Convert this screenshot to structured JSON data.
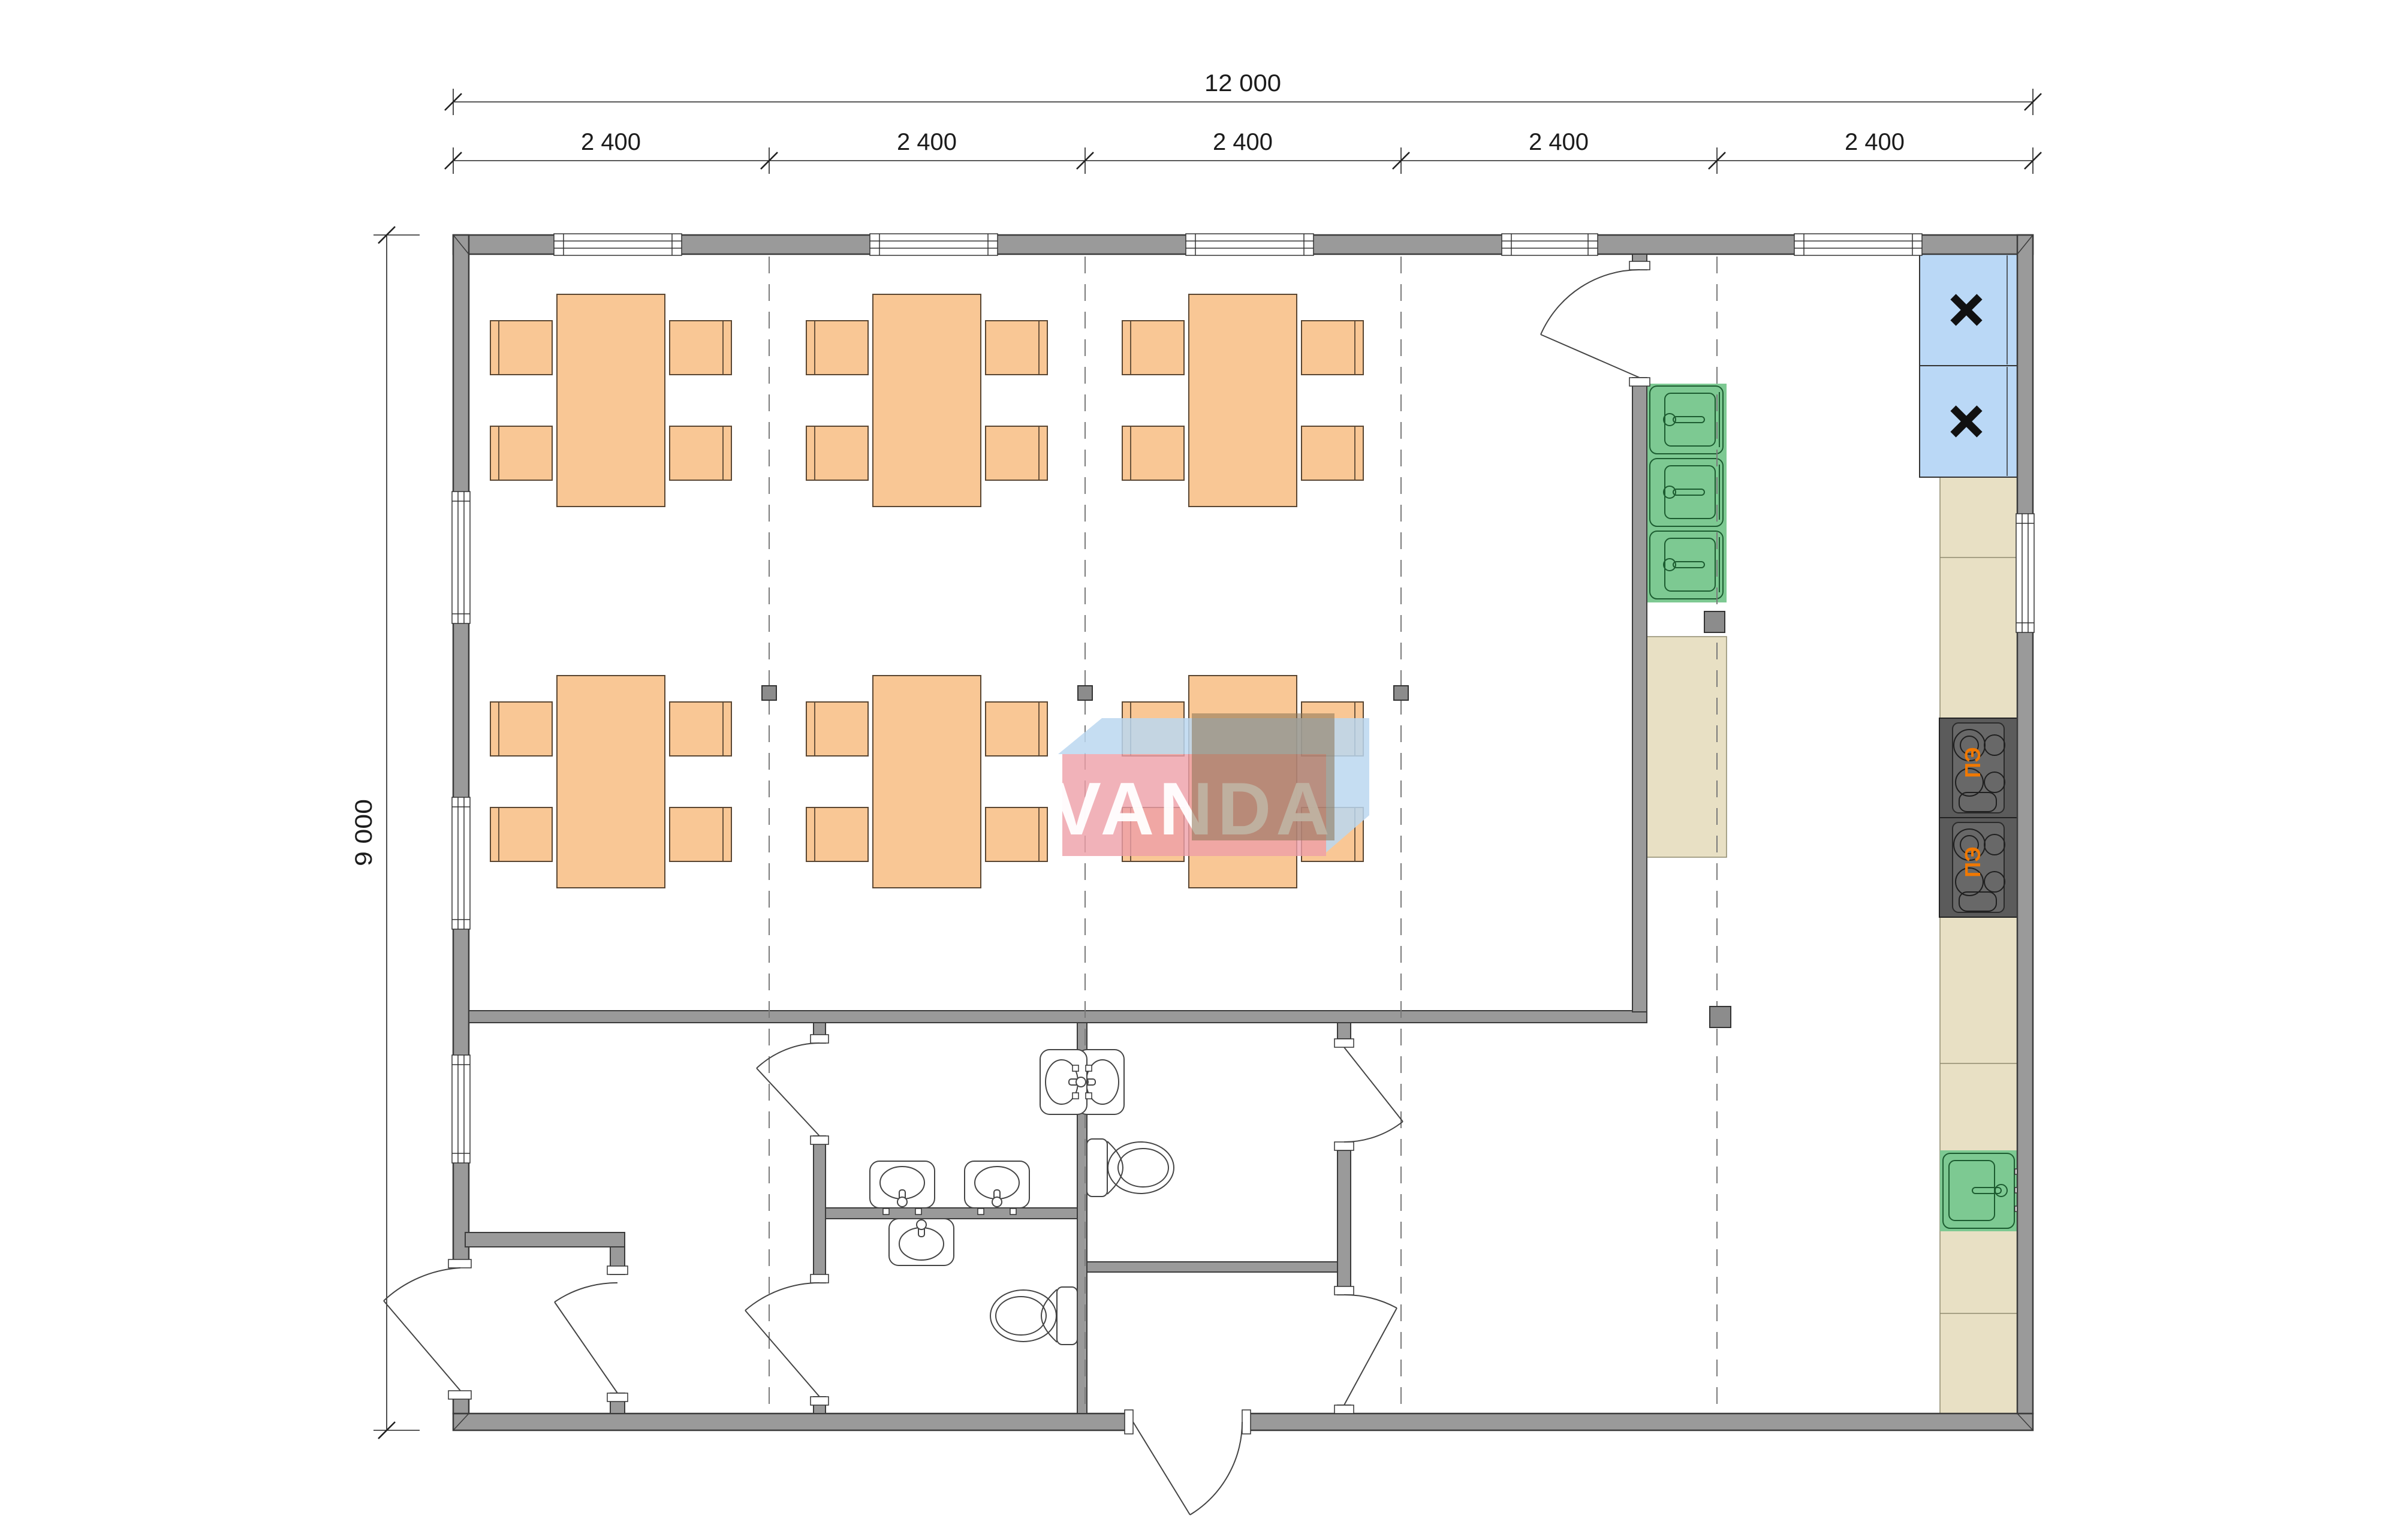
{
  "page": {
    "type": "architectural floor plan",
    "background": "#ffffff",
    "wall_color": "#9A9A9A",
    "grid_bays": 5
  },
  "dimensions": {
    "total_width_label": "12 000",
    "segment_labels": [
      "2 400",
      "2 400",
      "2 400",
      "2 400",
      "2 400"
    ],
    "total_height_label": "9 000"
  },
  "watermark": {
    "text": "VANDA",
    "front_color": "#EE9FA7",
    "top_color": "#BBD7F0",
    "shadow_color": "#8A7254",
    "text_color": "#ffffff"
  },
  "dining": {
    "tables": 6,
    "chairs_per_table": 4,
    "rows": 2,
    "table_color": "#F9C795"
  },
  "kitchen": {
    "stoves": [
      {
        "label": "ПЭ"
      },
      {
        "label": "ПЭ"
      }
    ],
    "stove_label_color": "#F07800",
    "refrigerators": [
      {
        "mark": "cross"
      },
      {
        "mark": "cross"
      }
    ],
    "refrigerator_color": "#BAD8F6",
    "sink_units": 3,
    "service_sink_units": 1,
    "sink_color": "#7DC992",
    "counter_color": "#E8E0C4",
    "stove_color": "#5B5B5B"
  },
  "sanitary": {
    "wash_basins": 5,
    "toilets": 2
  }
}
